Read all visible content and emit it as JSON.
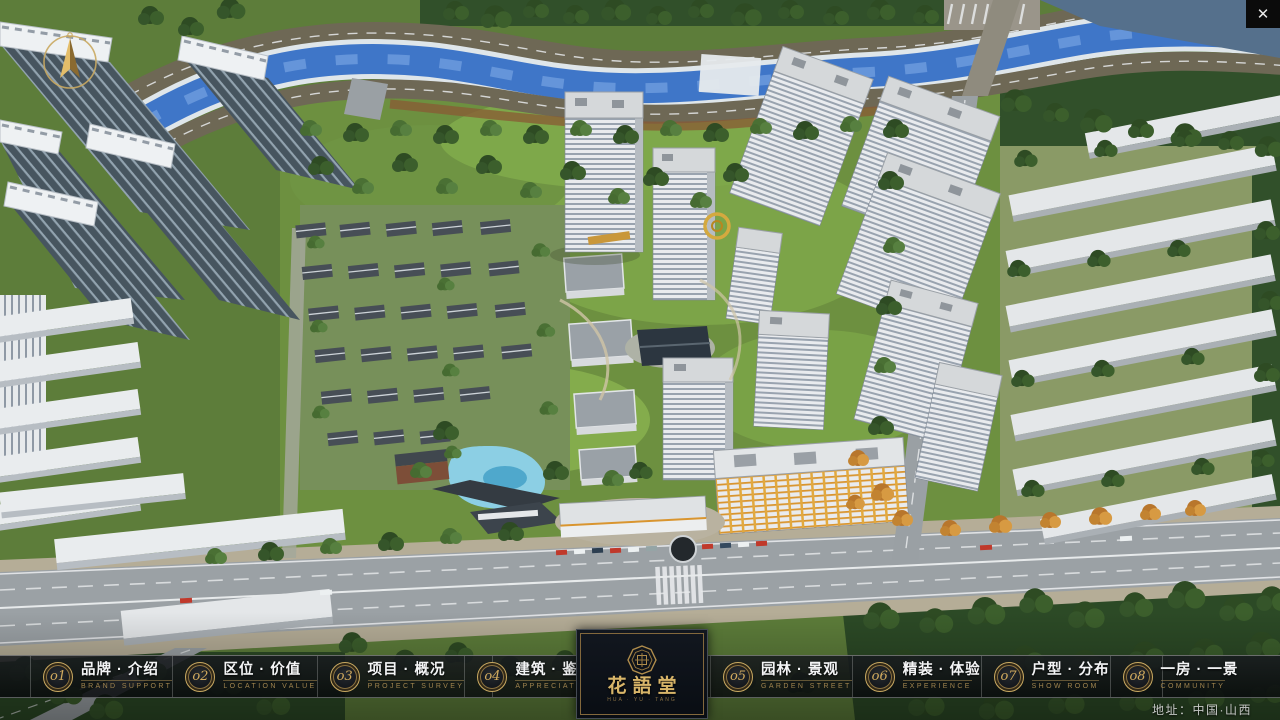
{
  "window": {
    "close_glyph": "✕"
  },
  "menu": {
    "items": [
      {
        "num": "o1",
        "label": "品牌 · 介绍",
        "sub": "BRAND SUPPORT"
      },
      {
        "num": "o2",
        "label": "区位 · 价值",
        "sub": "LOCATION VALUE"
      },
      {
        "num": "o3",
        "label": "项目 · 概况",
        "sub": "PROJECT SURVEY"
      },
      {
        "num": "o4",
        "label": "建筑 · 鉴赏",
        "sub": "APPRECIATION"
      },
      {
        "num": "o5",
        "label": "园林 · 景观",
        "sub": "GARDEN STREET"
      },
      {
        "num": "o6",
        "label": "精装 · 体验",
        "sub": "EXPERIENCE"
      },
      {
        "num": "o7",
        "label": "户型 · 分布",
        "sub": "SHOW ROOM"
      },
      {
        "num": "o8",
        "label": "一房 · 一景",
        "sub": "COMMUNITY"
      }
    ]
  },
  "logo": {
    "title": "花語堂",
    "caption": "HUA · YU · TANG"
  },
  "footer": {
    "address": "地址：中国·山西"
  },
  "colors": {
    "accent_gold": "#c9a961",
    "bar_background": "#0b0e11",
    "river_blue": "#3f76c8",
    "lawn_green": "#6d9040",
    "tower_white": "#e9ebee"
  }
}
